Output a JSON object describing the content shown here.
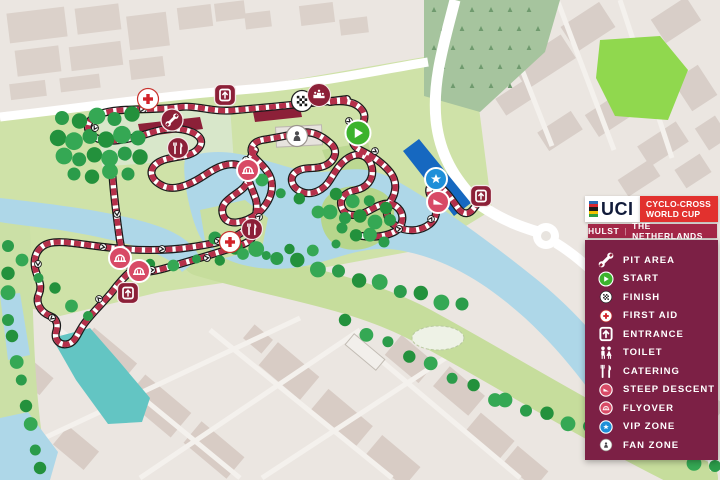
{
  "branding": {
    "uci_text": "UCI",
    "event_line1": "CYCLO-CROSS",
    "event_line2": "WORLD CUP",
    "location": "HULST",
    "divider": "|",
    "country": "THE NETHERLANDS",
    "colors": {
      "uci_red": "#e2312e",
      "location_bar": "#a32747",
      "legend_panel": "#7c2045",
      "uci_navy": "#111b3a"
    }
  },
  "legend": {
    "items": [
      {
        "id": "pit-area",
        "label": "PIT AREA",
        "icon": "wrench-icon"
      },
      {
        "id": "start",
        "label": "START",
        "icon": "start-play-icon"
      },
      {
        "id": "finish",
        "label": "FINISH",
        "icon": "checkered-flag-icon"
      },
      {
        "id": "first-aid",
        "label": "FIRST AID",
        "icon": "red-cross-icon"
      },
      {
        "id": "entrance",
        "label": "ENTRANCE",
        "icon": "entrance-door-icon"
      },
      {
        "id": "toilet",
        "label": "TOILET",
        "icon": "toilet-figures-icon"
      },
      {
        "id": "catering",
        "label": "CATERING",
        "icon": "fork-knife-icon"
      },
      {
        "id": "steep-descent",
        "label": "STEEP DESCENT",
        "icon": "descent-ramp-icon"
      },
      {
        "id": "flyover",
        "label": "FLYOVER",
        "icon": "flyover-bridge-icon"
      },
      {
        "id": "vip-zone",
        "label": "VIP ZONE",
        "icon": "vip-star-icon"
      },
      {
        "id": "fan-zone",
        "label": "FAN ZONE",
        "icon": "fan-person-icon"
      }
    ]
  },
  "map": {
    "markers": [
      {
        "type": "first-aid",
        "x": 148,
        "y": 99
      },
      {
        "type": "entrance",
        "x": 225,
        "y": 95
      },
      {
        "type": "pit-area",
        "x": 172,
        "y": 120
      },
      {
        "type": "catering",
        "x": 178,
        "y": 148
      },
      {
        "type": "finish",
        "x": 302,
        "y": 101
      },
      {
        "type": "podium",
        "x": 319,
        "y": 95
      },
      {
        "type": "fan-zone",
        "x": 297,
        "y": 136
      },
      {
        "type": "start",
        "x": 358,
        "y": 133
      },
      {
        "type": "flyover",
        "x": 248,
        "y": 170
      },
      {
        "type": "vip-zone",
        "x": 436,
        "y": 179
      },
      {
        "type": "steep-descent",
        "x": 438,
        "y": 202
      },
      {
        "type": "entrance",
        "x": 481,
        "y": 196
      },
      {
        "type": "catering",
        "x": 252,
        "y": 229
      },
      {
        "type": "first-aid",
        "x": 230,
        "y": 242
      },
      {
        "type": "flyover",
        "x": 120,
        "y": 258
      },
      {
        "type": "flyover",
        "x": 139,
        "y": 271
      },
      {
        "type": "entrance",
        "x": 128,
        "y": 293
      }
    ],
    "colors": {
      "course": "#b5304a",
      "course_outline": "#1a1a1a",
      "water": "#aed7e8",
      "canal": "#63c5c3",
      "park": "#cfe2a8",
      "bank": "#c6dd9c",
      "tree": "#2b9c4a",
      "city_block": "#d8ccc5",
      "road": "#ffffff",
      "marker_maroon": "#8c2038",
      "marker_pink": "#d84a66",
      "vip_blue": "#1f8fd8",
      "start_green": "#3cb32d",
      "vip_area": "#1668c0"
    }
  }
}
